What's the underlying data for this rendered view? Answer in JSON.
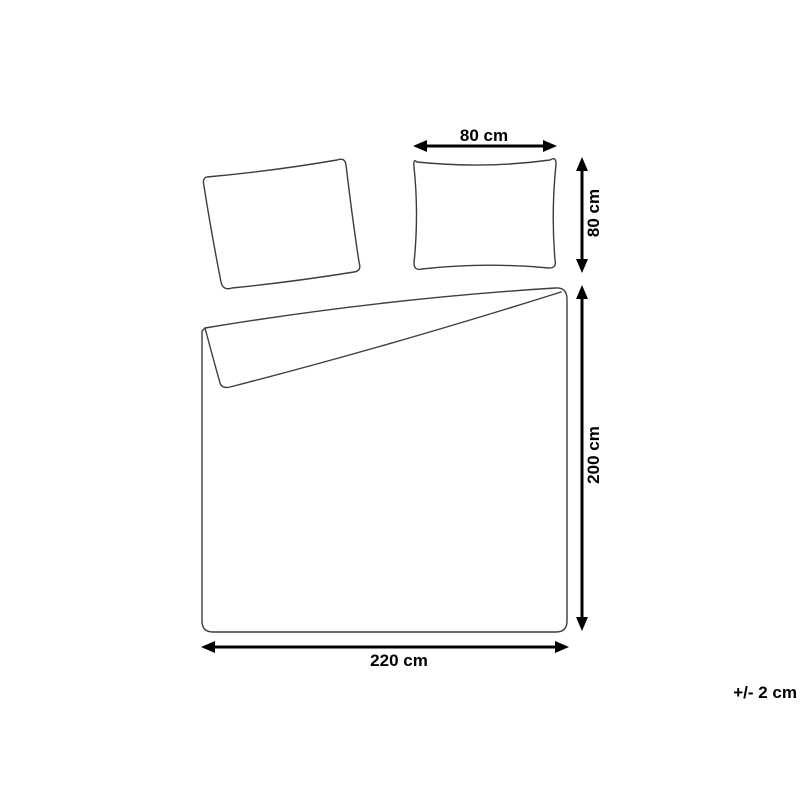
{
  "diagram": {
    "type": "product-dimension-drawing",
    "product": "duvet cover and pillowcase set",
    "pillow": {
      "width_label": "80 cm",
      "height_label": "80 cm"
    },
    "duvet": {
      "width_label": "220 cm",
      "height_label": "200 cm"
    },
    "tolerance_note": "+/- 2 cm",
    "colors": {
      "background": "#ffffff",
      "outline": "#3d3d3d",
      "dimension": "#000000"
    }
  }
}
